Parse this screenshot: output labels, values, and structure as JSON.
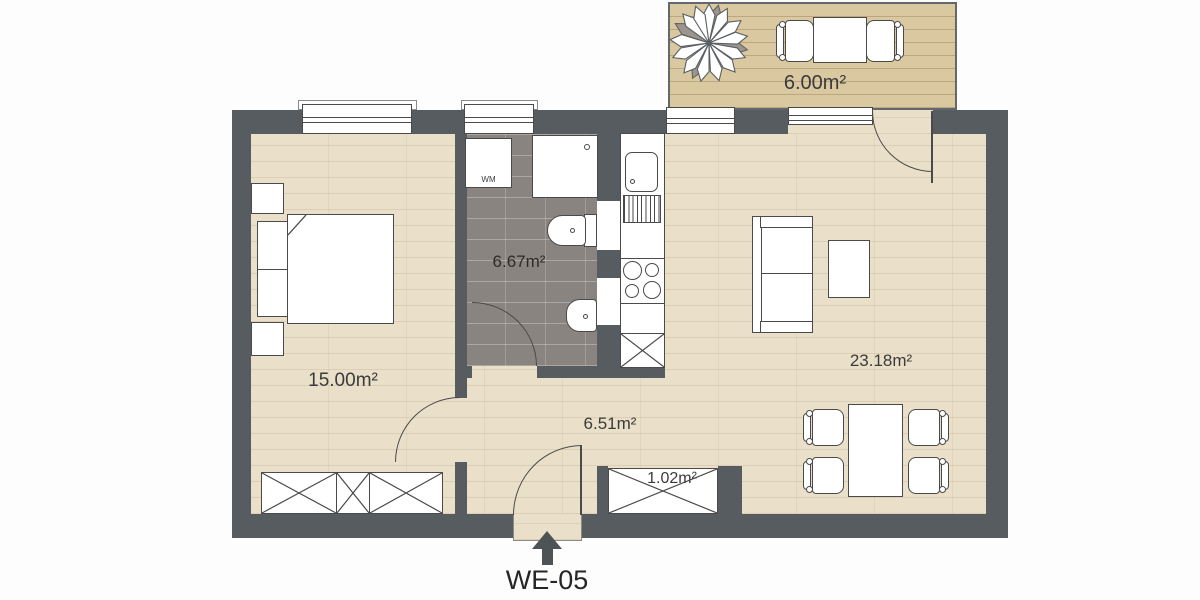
{
  "unit": {
    "label": "WE-05"
  },
  "rooms": {
    "bedroom": {
      "area_label": "15.00m²"
    },
    "bathroom": {
      "area_label": "6.67m²"
    },
    "hallway": {
      "area_label": "6.51m²"
    },
    "living_room": {
      "area_label": "23.18m²"
    },
    "balcony": {
      "area_label": "6.00m²"
    },
    "closet": {
      "area_label": "1.02m²"
    }
  },
  "appliances": {
    "washing_machine_label": "WM"
  },
  "colors": {
    "wall": "#575c60",
    "floor_wood": "#eadfc8",
    "balcony_deck": "#d9c8a0",
    "bathroom_tile": "#8a8480",
    "furniture_outline": "#4a4a4a",
    "label_text": "#3b3b3b"
  }
}
